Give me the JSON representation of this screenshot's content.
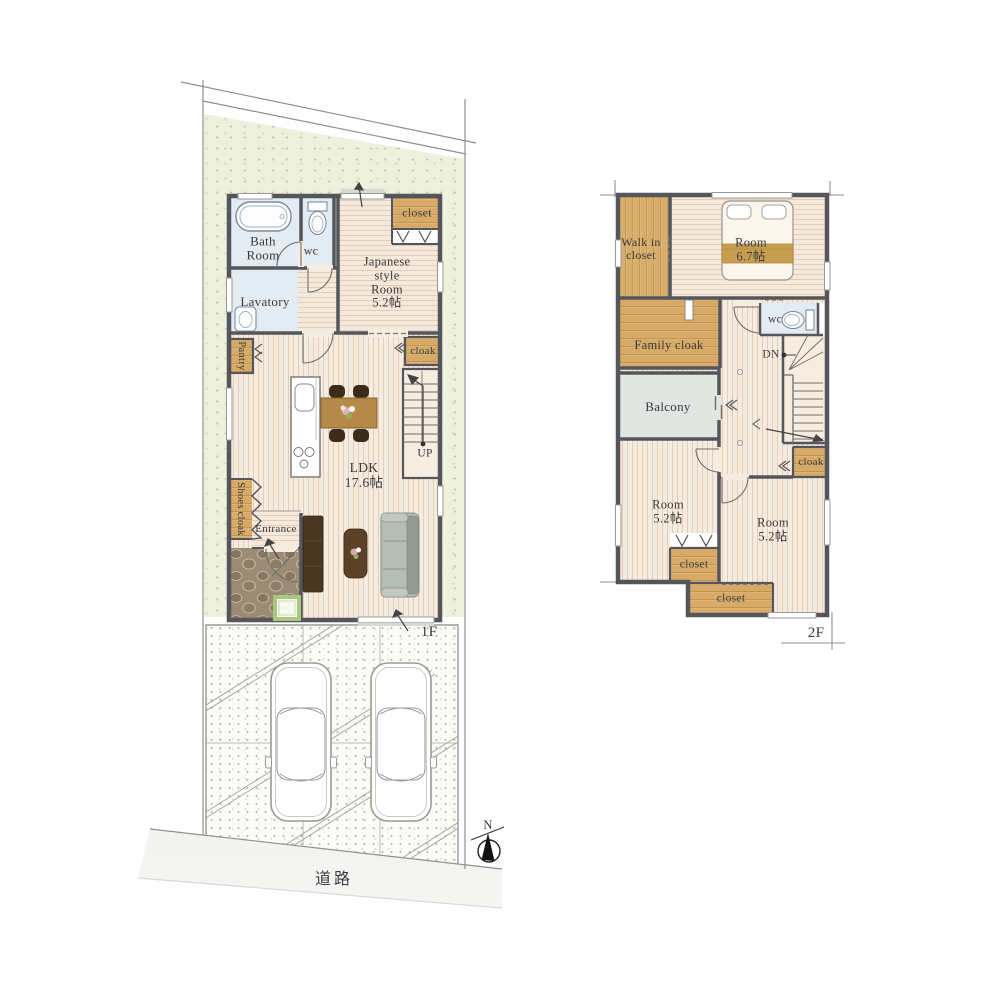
{
  "floor1": {
    "label": "1F",
    "rooms": {
      "bath_room": "Bath Room",
      "wc": "wc",
      "lavatory": "Lavatory",
      "closet": "closet",
      "japanese_room": "Japanese style Room",
      "japanese_room_size": "5.2帖",
      "pantry": "Pantry",
      "cloak": "cloak",
      "ldk": "LDK",
      "ldk_size": "17.6帖",
      "stairs_up": "UP",
      "shoes_cloak": "Shoes cloak",
      "entrance": "Entrance"
    }
  },
  "floor2": {
    "label": "2F",
    "rooms": {
      "walk_in_closet": "Walk in closet",
      "main_room": "Room",
      "main_room_size": "6.7帖",
      "family_cloak": "Family cloak",
      "wc": "wc",
      "stairs_down": "DN",
      "balcony": "Balcony",
      "cloak": "cloak",
      "room_left": "Room",
      "room_left_size": "5.2帖",
      "room_right": "Room",
      "room_right_size": "5.2帖",
      "closet_left": "closet",
      "closet_bottom": "closet"
    }
  },
  "site": {
    "road": "道路",
    "compass_north": "N"
  },
  "colors": {
    "wall": "#54565c",
    "wood_cabinet": "#d7ab67",
    "floor_base": "#f6ebdf",
    "floor_stripe": "#e2cdbd",
    "water_room_blue": "#e3ebf3",
    "lot_green": "#edf1dd",
    "balcony_gray": "#e1e6e3",
    "entrance_stone": "#9b8a74",
    "road_gray": "#e2e2e0",
    "blanket_brown": "#c79e51"
  }
}
